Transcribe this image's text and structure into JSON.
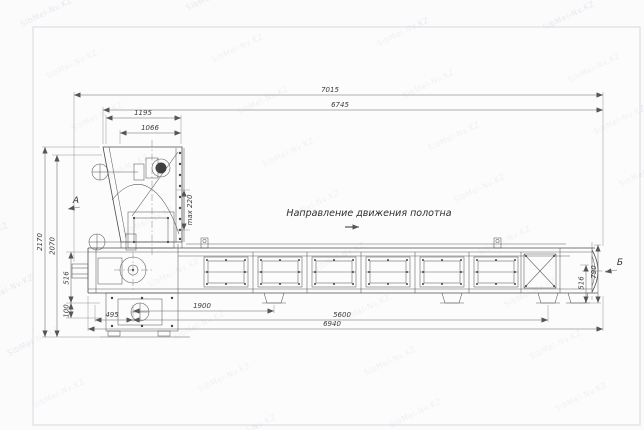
{
  "watermark": {
    "text": "SibMel-Nv.KZ"
  },
  "annotation": {
    "belt_direction": "Направление движения полотна"
  },
  "views": {
    "a_label": "А",
    "b_label": "Б"
  },
  "dims": {
    "top_overall": "7015",
    "top_secondary": "6745",
    "hopper_width": "1195",
    "hopper_opening": "1066",
    "left_height_overall": "2170",
    "left_height_inner": "2070",
    "left_belt_height": "516",
    "left_foot_offset": "100",
    "hopper_max_opening": "max 220",
    "bottom_first": "495",
    "bottom_leg_spacing": "1900",
    "bottom_frame_span": "5600",
    "bottom_overall": "6940",
    "right_belt_height": "516",
    "right_end_height": "790"
  },
  "colors": {
    "line": "#4d4d4d",
    "dimension": "#666666",
    "text": "#3a3a3a",
    "watermark": "#b9c1cf",
    "frame": "#ccd0d9",
    "pulley_fill": "#3f3f3f"
  }
}
